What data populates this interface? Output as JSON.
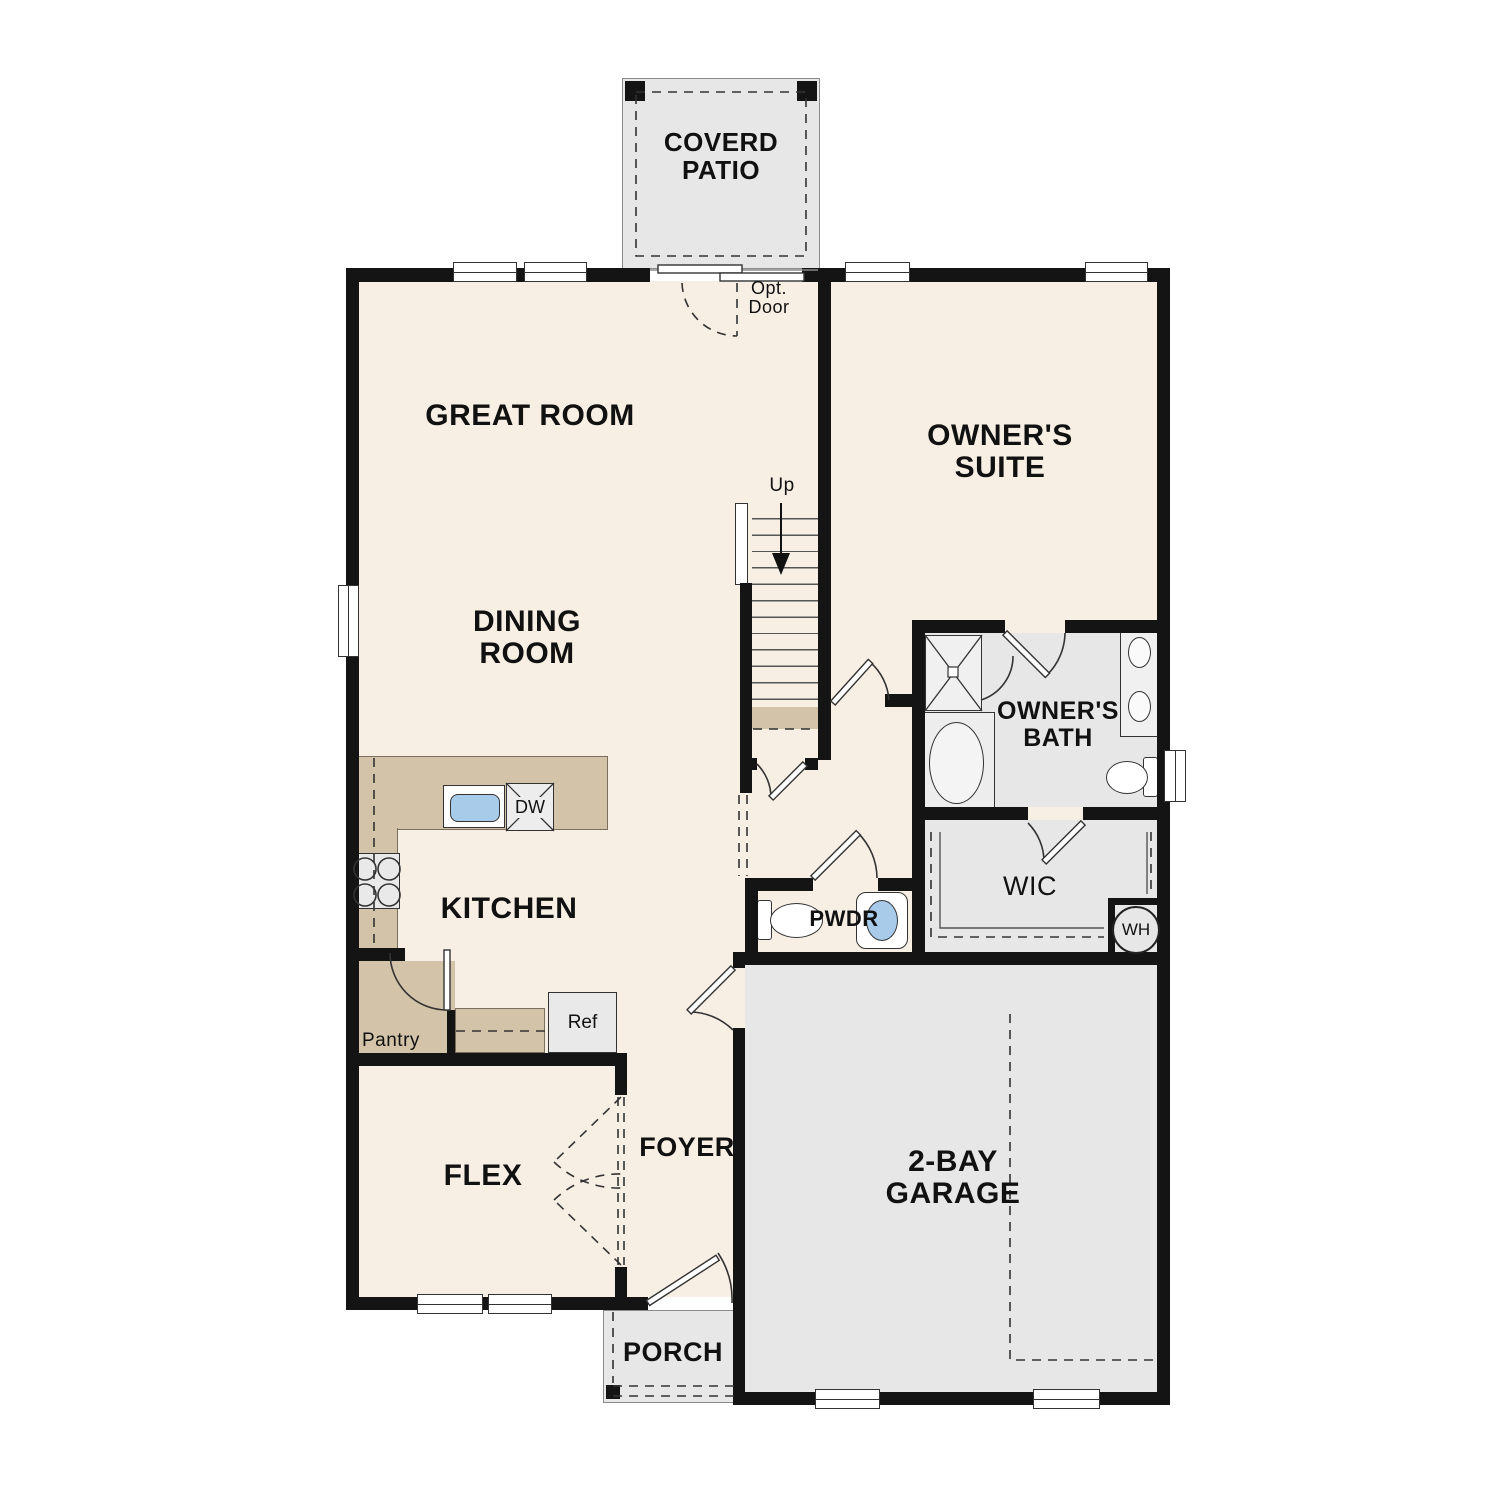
{
  "labels": {
    "covered_patio": [
      "COVERD",
      "PATIO"
    ],
    "great_room": "GREAT ROOM",
    "owners_suite": [
      "OWNER'S",
      "SUITE"
    ],
    "dining_room": [
      "DINING",
      "ROOM"
    ],
    "kitchen": "KITCHEN",
    "owners_bath": [
      "OWNER'S",
      "BATH"
    ],
    "wic": "WIC",
    "wh": "WH",
    "pwdr": "PWDR",
    "pantry": "Pantry",
    "ref": "Ref",
    "dw": "DW",
    "up": "Up",
    "opt_door": [
      "Opt.",
      "Door"
    ],
    "flex": "FLEX",
    "foyer": "FOYER",
    "garage": [
      "2-BAY",
      "GARAGE"
    ],
    "porch": "PORCH"
  },
  "colors": {
    "floor": "#f8efe4",
    "surface": "#e7e7e7",
    "counter": "#d3c4a9",
    "wall": "#141414",
    "line": "#333333",
    "fixture_blue": "#a9cbea"
  }
}
